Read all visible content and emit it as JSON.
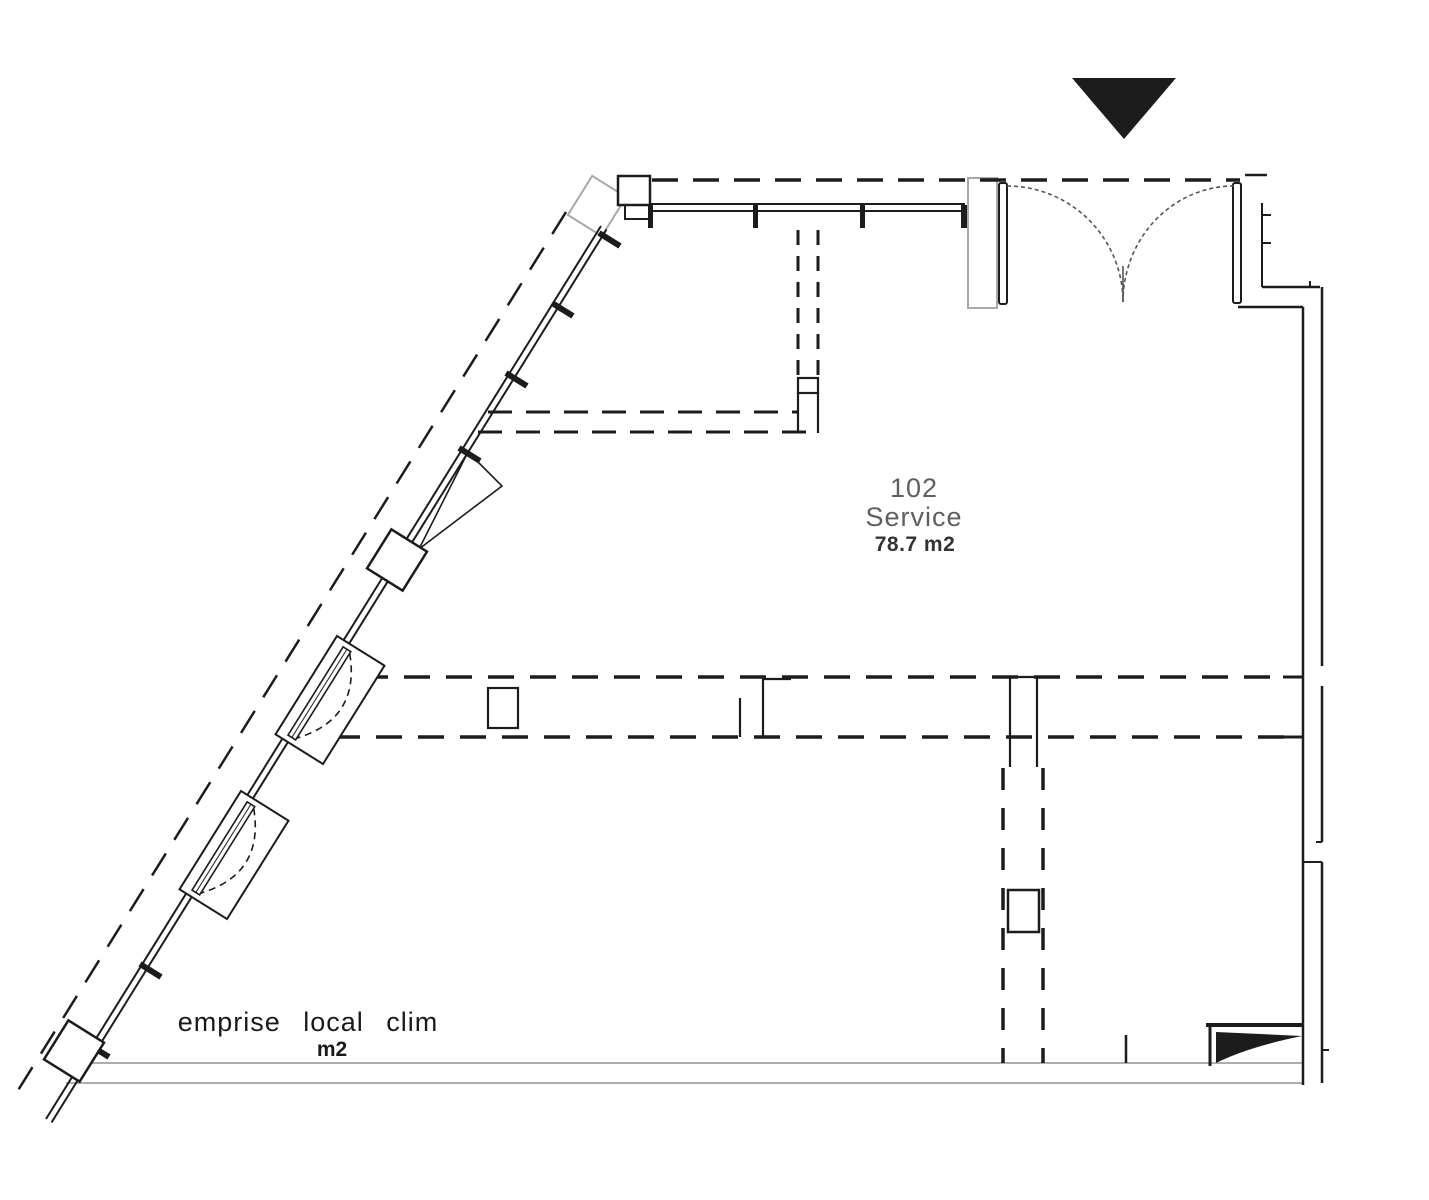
{
  "drawing": {
    "type": "architectural-floor-plan",
    "room_label": {
      "number": "102",
      "name": "Service",
      "area": "78.7 m2"
    },
    "annotation": {
      "text": "emprise local clim",
      "unit": "m2"
    },
    "icons": {
      "entrance_arrow": "filled-triangle-pointing-down",
      "double_door": "two-quarter-circle-swing-arcs"
    },
    "colors": {
      "ink": "#1c1c1c",
      "gray": "#a8a8a8",
      "label_gray": "#5f5f5f",
      "label_dark": "#333333",
      "annotation_ink": "#1a1a1a",
      "arc_gray": "#555555",
      "background": "#ffffff"
    }
  }
}
